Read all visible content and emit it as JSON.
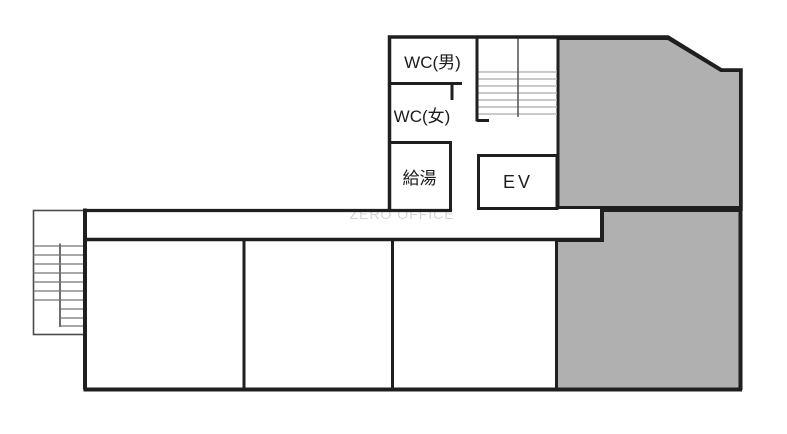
{
  "watermark": {
    "text": "ZERO OFFICE"
  },
  "rooms": {
    "wc_men": {
      "label": "WC(男)"
    },
    "wc_women": {
      "label": "WC(女)"
    },
    "water_heater": {
      "label": "給湯"
    },
    "elevator": {
      "label": "EV"
    }
  },
  "colors": {
    "wall": "#1f1f1f",
    "gray_fill": "#b0b0b0",
    "stair_outline": "#4a4a4a",
    "stair_tread": "#757575",
    "upper_stair_tread": "#b7b7b7",
    "watermark_text": "#d4d4d4",
    "background": "#ffffff"
  }
}
